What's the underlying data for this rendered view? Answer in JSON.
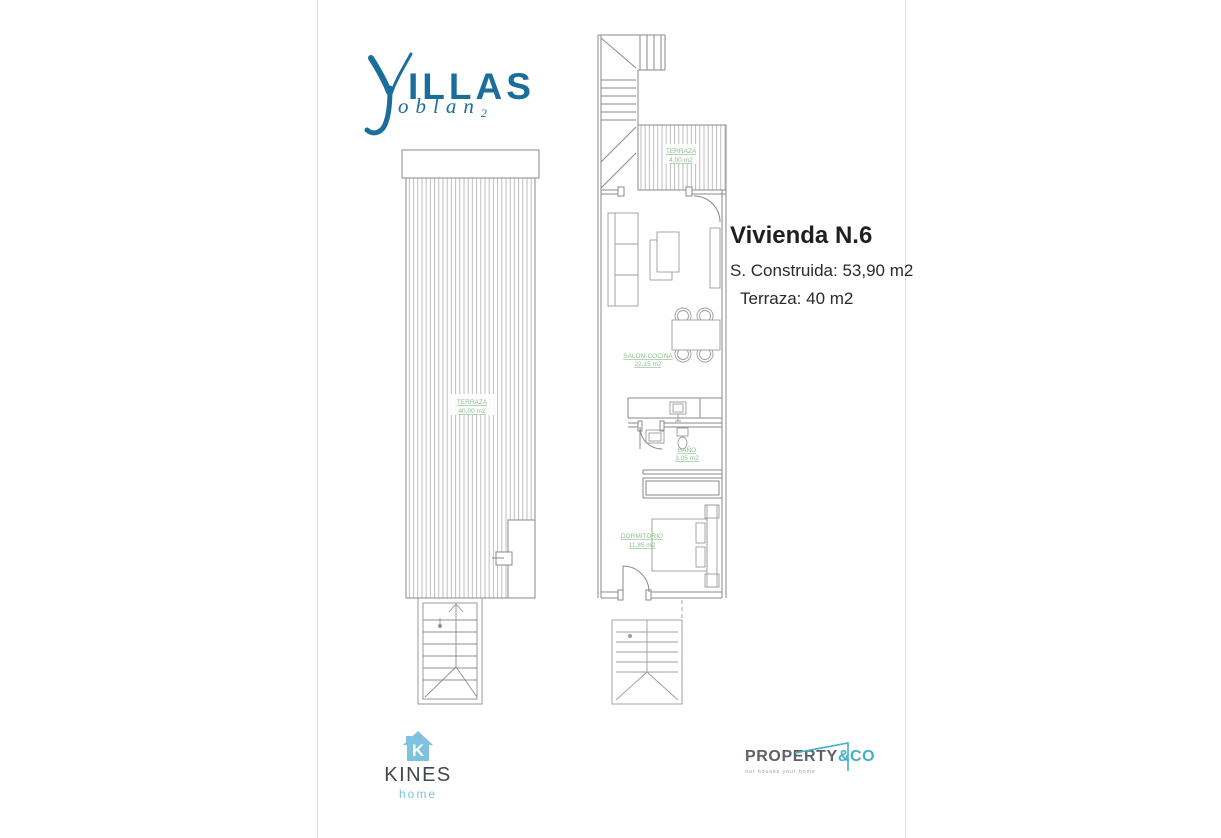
{
  "brand": {
    "word": "ILLAS",
    "sub_word": "oblan",
    "sub_index": "2",
    "color": "#1b6d9c"
  },
  "unit_info": {
    "title": "Vivienda N.6",
    "built": "S. Construida: 53,90 m2",
    "terrace": "Terraza: 40 m2"
  },
  "plans": {
    "left": {
      "terraza_label": "TERRAZA",
      "terraza_area": "40,00 m2"
    },
    "right": {
      "terraza_label": "TERRAZA",
      "terraza_area": "4,00 m2",
      "salon_label": "SALON-COCINA",
      "salon_area": "22,15 m2",
      "bano_label": "BAÑO",
      "bano_area": "3,05 m2",
      "dorm_label": "DORMITORIO",
      "dorm_area": "11,85 m2"
    }
  },
  "footer": {
    "kines": {
      "name": "KINES",
      "tagline": "home",
      "icon_letter": "K"
    },
    "property": {
      "name": "PROPERTY",
      "suffix": "&CO",
      "tagline": "our houses your home"
    }
  },
  "icons": {
    "villas_glyph": "yj-ligature-icon",
    "kines_house": "house-icon",
    "property_roof": "roof-outline-icon"
  },
  "colors": {
    "logo_blue": "#1b6d9c",
    "label_green": "#8cbf8c",
    "kines_blue": "#7fc2e0",
    "property_teal": "#41b0ca",
    "property_gray": "#5d6269",
    "plan_line_gray": "#8a8a8a"
  }
}
